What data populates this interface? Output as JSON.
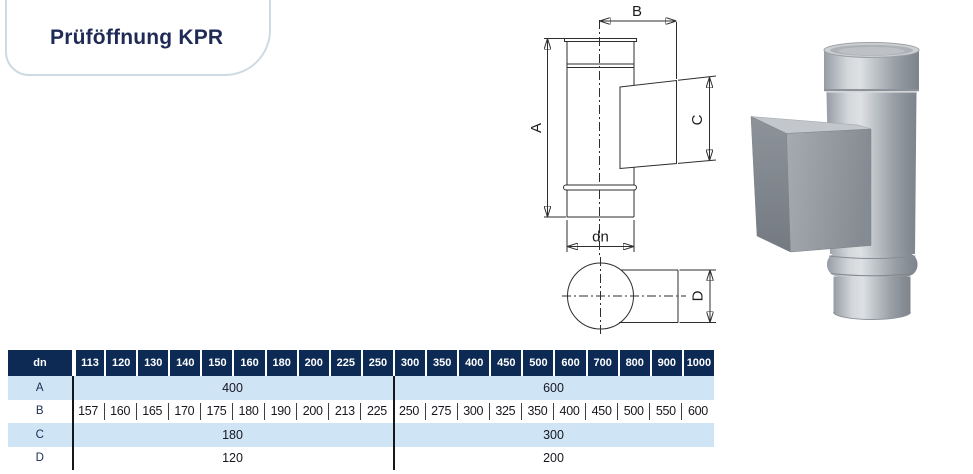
{
  "page": {
    "title": "Prüföffnung KPR"
  },
  "colors": {
    "header_navy": "#0d2a55",
    "row_light_blue": "#cfe5f6",
    "title_navy": "#1f2b56",
    "drawing_line": "#2e2e2e"
  },
  "diagram": {
    "labels": {
      "A": "A",
      "B": "B",
      "C": "C",
      "D": "D",
      "dn": "dn"
    }
  },
  "table": {
    "row_label_header": "dn",
    "columns": [
      "113",
      "120",
      "130",
      "140",
      "150",
      "160",
      "180",
      "200",
      "225",
      "250",
      "300",
      "350",
      "400",
      "450",
      "500",
      "600",
      "700",
      "800",
      "900",
      "1000"
    ],
    "group_split_index": 10,
    "rows": [
      {
        "label": "A",
        "group1": "400",
        "group2": "600"
      },
      {
        "label": "B",
        "values": [
          "157",
          "160",
          "165",
          "170",
          "175",
          "180",
          "190",
          "200",
          "213",
          "225",
          "250",
          "275",
          "300",
          "325",
          "350",
          "400",
          "450",
          "500",
          "550",
          "600"
        ]
      },
      {
        "label": "C",
        "group1": "180",
        "group2": "300"
      },
      {
        "label": "D",
        "group1": "120",
        "group2": "200"
      }
    ]
  }
}
